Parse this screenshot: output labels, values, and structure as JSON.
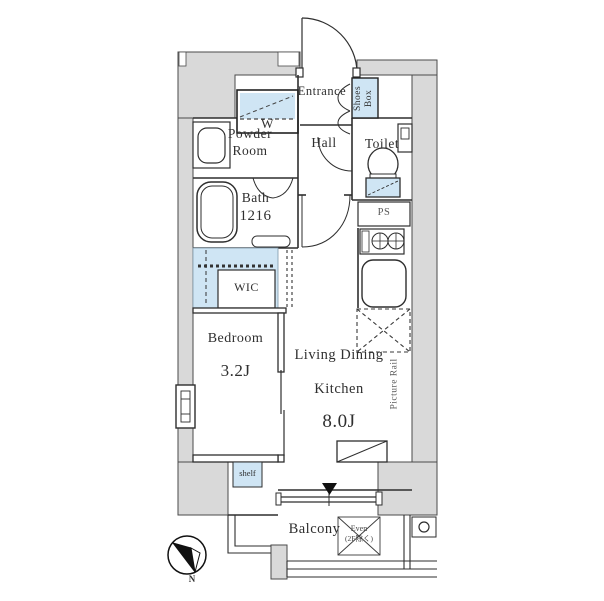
{
  "floorplan": {
    "rooms": {
      "entrance": {
        "label": "Entrance"
      },
      "shoes_box": {
        "line1": "Shoes",
        "line2": "Box"
      },
      "washer": {
        "label": "W"
      },
      "powder_room": {
        "line1": "Powder",
        "line2": "Room"
      },
      "hall": {
        "label": "Hall"
      },
      "toilet": {
        "label": "Toilet"
      },
      "bath": {
        "name": "Bath",
        "size": "1216"
      },
      "pipe_space": {
        "label": "PS"
      },
      "wic": {
        "label": "WIC"
      },
      "bedroom": {
        "name": "Bedroom",
        "size": "3.2J"
      },
      "ldk": {
        "line1": "Living Dining",
        "line2": "Kitchen",
        "size": "8.0J"
      },
      "picture_rail": {
        "label": "Picture Rail"
      },
      "shelf": {
        "label": "shelf"
      },
      "balcony": {
        "label": "Balcony"
      },
      "evac_hatch": {
        "line1": "Even",
        "line2": "(2F除く)"
      }
    },
    "compass": {
      "north_label": "N"
    },
    "colors": {
      "wall_fill": "#d9d9d9",
      "fixture_blue": "#cfe5f4",
      "line": "#2e2e2e"
    }
  }
}
